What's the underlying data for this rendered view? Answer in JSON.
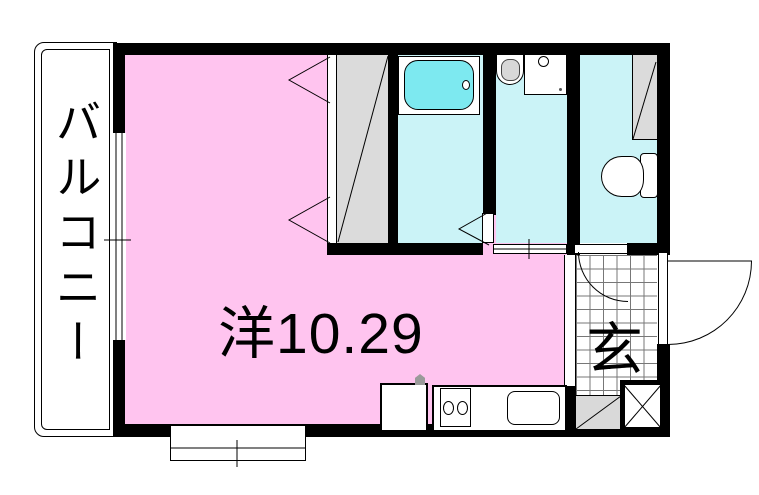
{
  "plan": {
    "type": "apartment-floorplan",
    "rooms": {
      "balcony": {
        "label": "バルコニー"
      },
      "main_room": {
        "label": "洋10.29"
      },
      "entrance": {
        "label": "玄"
      }
    },
    "fixtures": [
      "bathtub",
      "washbasin",
      "washing-machine-pan",
      "toilet",
      "storage-shelf",
      "closet",
      "kitchen-stove",
      "kitchen-sink",
      "laundry-pan",
      "shoe-cabinet",
      "pipe-space",
      "entry-door",
      "toilet-door",
      "bathroom-folding-door",
      "sliding-door",
      "window"
    ],
    "colors": {
      "room_pink": "#FFC4EF",
      "wet_area_cyan": "#CBF3F7",
      "bathtub_cyan": "#7DE9F0",
      "closet_gray": "#DBDBDB",
      "wall_black": "#000000",
      "tile_grid_line": "#777777"
    }
  }
}
